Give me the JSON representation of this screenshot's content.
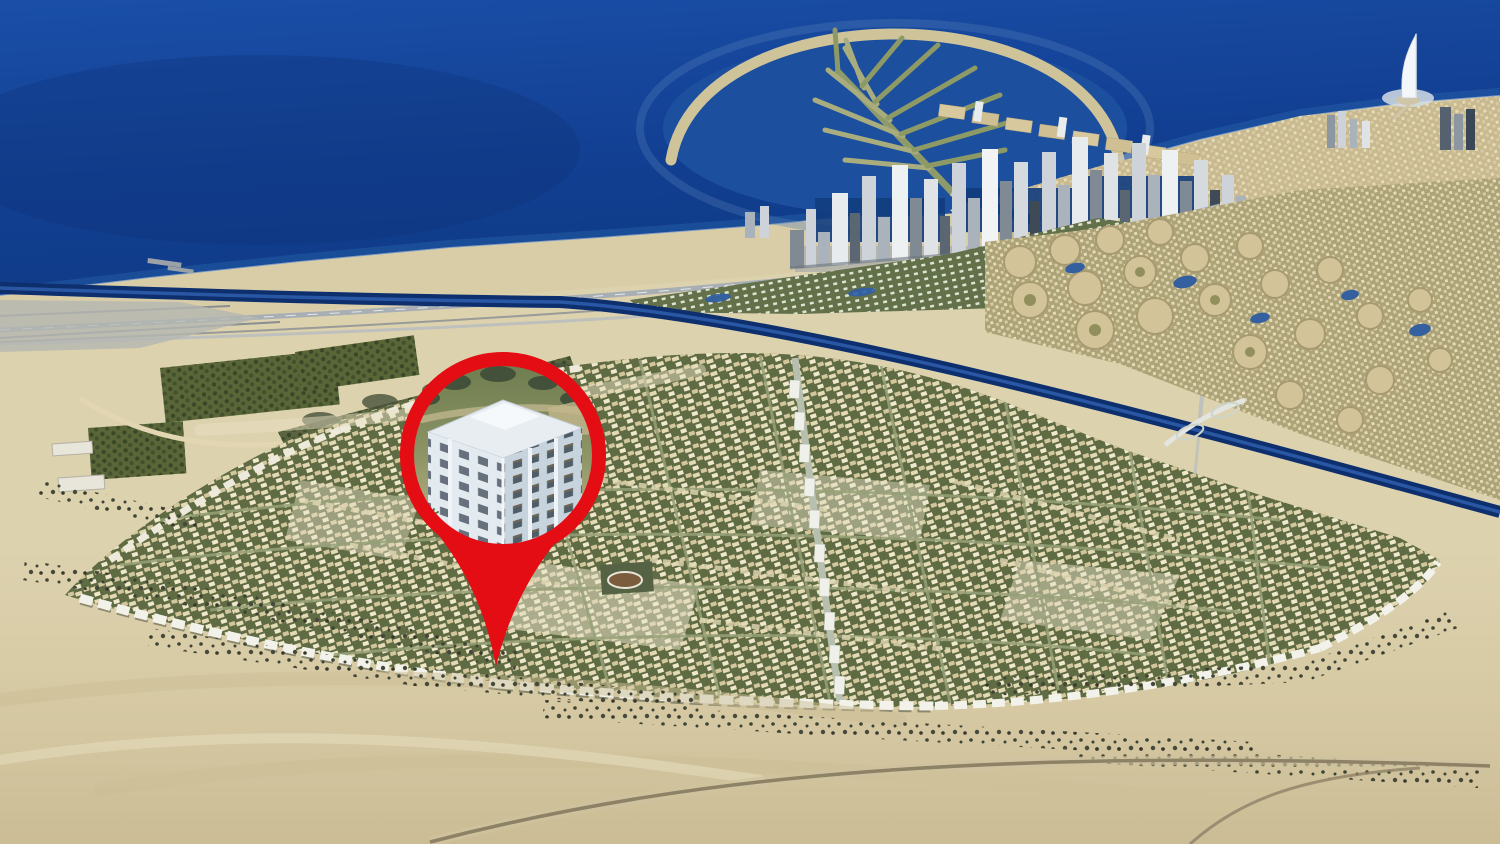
{
  "scene": {
    "kind": "aerial-photograph",
    "marker": {
      "icon": "location-pin-icon",
      "content": "building-rendering-icon"
    }
  },
  "palette": {
    "sea": "#16449c",
    "sea_deep": "#0d3578",
    "lagoon": "#1c4f9e",
    "beach_sand": "#d9cda8",
    "desert_sand": "#ddd2ae",
    "desert_shadow": "#c0ae83",
    "greenbelt": "#63714a",
    "development_green": "#5f6b42",
    "town_beige": "#d8c9a2",
    "white_buildings": "#f3f2ea",
    "canal": "#0d2f6e",
    "road_grey": "#a7aeb4",
    "skyline_grey": "#aab3bb",
    "shrub_dark": "#3e4433",
    "pin_red": "#e40d14",
    "pin_building_white": "#dfe7ee"
  }
}
